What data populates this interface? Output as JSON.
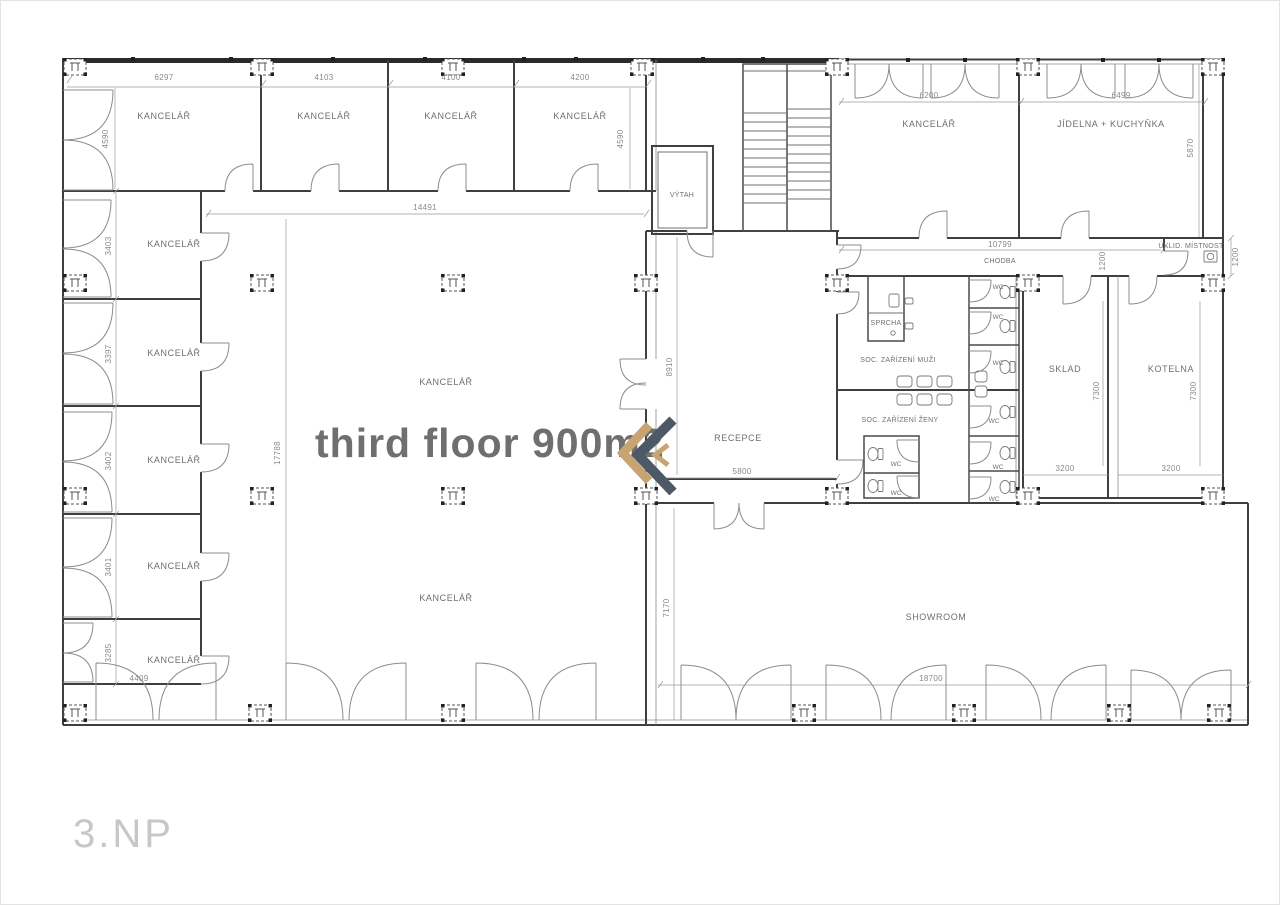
{
  "floor_label": "3.NP",
  "annotation": {
    "text": "third floor  900m2",
    "color": "#e3222a"
  },
  "logo": {
    "icon": "k-monogram",
    "dark_color": "#4d5966",
    "gold_color": "#c8a472"
  },
  "rooms": {
    "office": "KANCELÁŘ",
    "elevator": "VÝTAH",
    "reception": "RECEPCE",
    "dining": "JÍDELNA + KUCHYŇKA",
    "corridor": "CHODBA",
    "cleaning": "ÚKLID. MÍSTNOST",
    "shower": "SPRCHA",
    "san_men": "SOC. ZAŘÍZENÍ MUŽI",
    "san_women": "SOC. ZAŘÍZENÍ ŽENY",
    "storage": "SKLAD",
    "boiler": "KOTELNA",
    "showroom": "SHOWROOM",
    "wc": "WC"
  },
  "dimensions": {
    "top_offices": [
      "6297",
      "4103",
      "4100",
      "4200"
    ],
    "top_office_depth_left": "4590",
    "top_office_depth_right": "4590",
    "left_offices": [
      "3403",
      "3397",
      "3402",
      "3401",
      "3285"
    ],
    "left_office_width": "4409",
    "hall_width": "14491",
    "hall_depth": "17788",
    "reception_depth": "8910",
    "reception_width": "5800",
    "right_office_width": "6200",
    "dining_width": "6499",
    "dining_depth": "5870",
    "corridor_length": "10799",
    "corridor_width": "1200",
    "cleaning_depth": "1200",
    "storage_depth": "7300",
    "boiler_depth": "7300",
    "storage_width": "3200",
    "boiler_width": "3200",
    "showroom_depth": "7170",
    "showroom_width": "18700"
  }
}
